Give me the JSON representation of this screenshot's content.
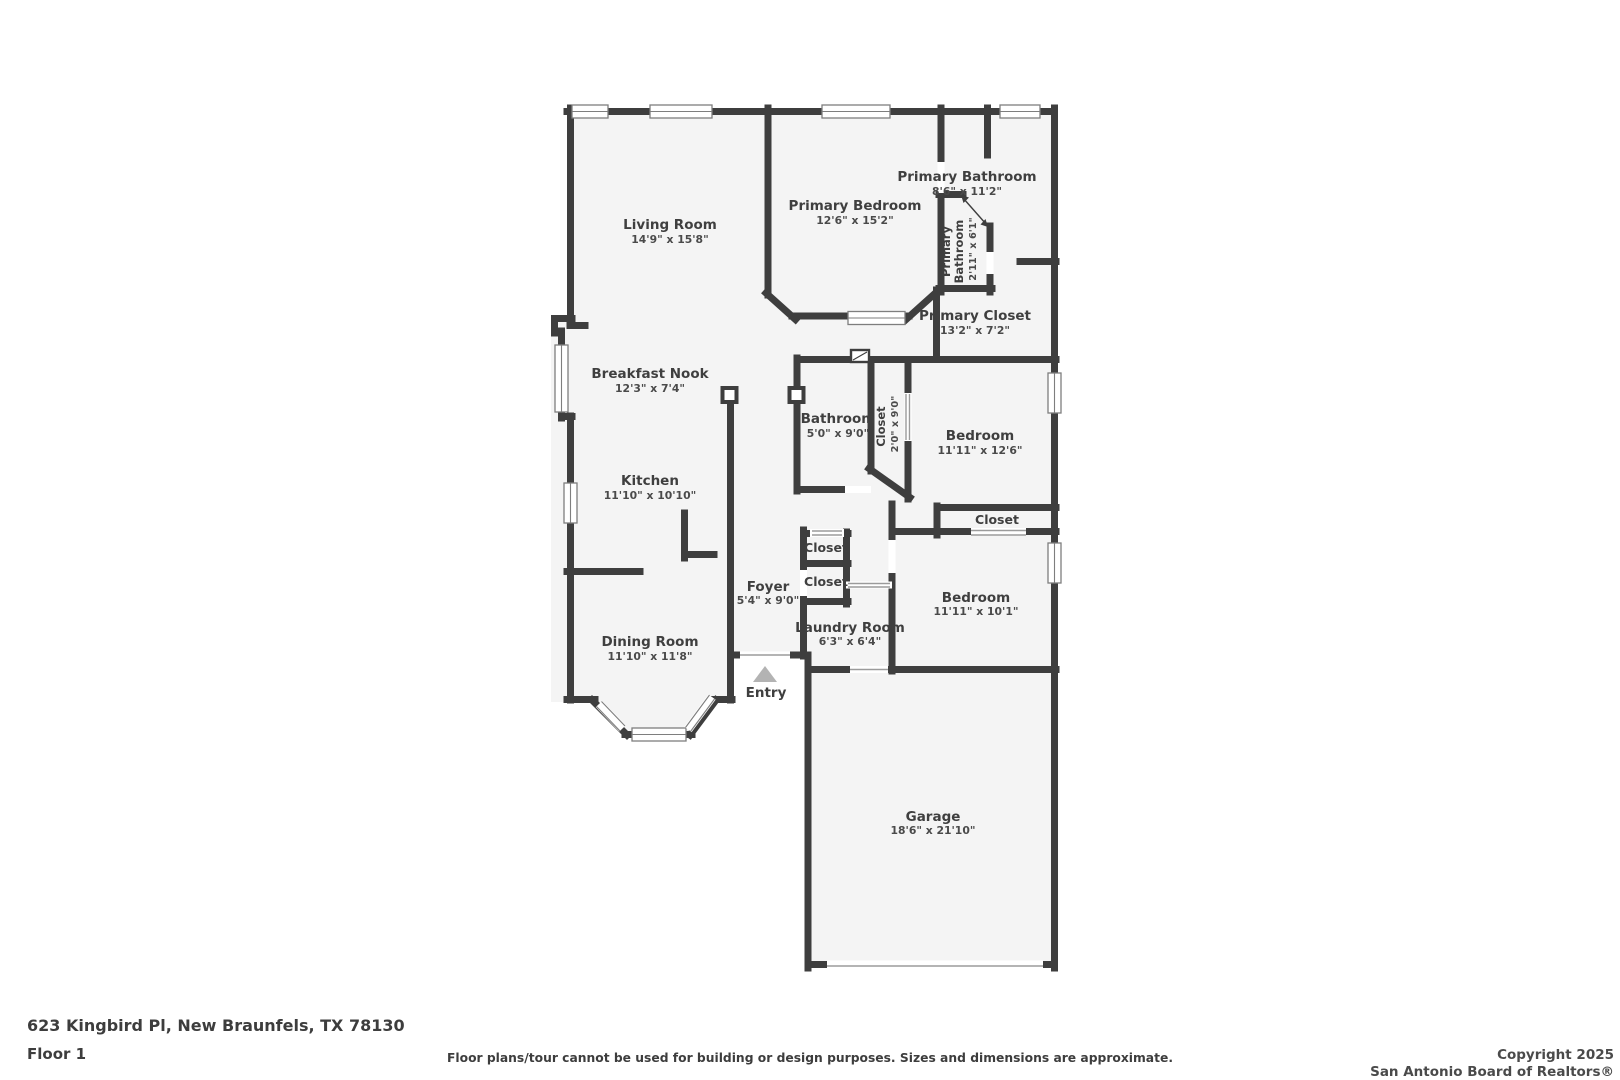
{
  "floorplan": {
    "wall_color": "#3e3e3e",
    "floor_color": "#f4f4f4",
    "window_frame_color": "#7e7e7e",
    "entry_arrow_color": "#b3b3b3",
    "rooms": [
      {
        "id": "living-room",
        "name": "Living Room",
        "dims": "14'9\" x 15'8\""
      },
      {
        "id": "primary-bedroom",
        "name": "Primary Bedroom",
        "dims": "12'6\" x 15'2\""
      },
      {
        "id": "primary-bathroom",
        "name": "Primary Bathroom",
        "dims": "8'6\" x 11'2\""
      },
      {
        "id": "primary-half-bathroom",
        "name": "Primary Bathroom",
        "name_line1": "Primary",
        "name_line2": "Bathroom",
        "dims": "2'11\" x 6'1\""
      },
      {
        "id": "primary-closet",
        "name": "Primary Closet",
        "dims": "13'2\" x 7'2\""
      },
      {
        "id": "breakfast-nook",
        "name": "Breakfast Nook",
        "dims": "12'3\" x 7'4\""
      },
      {
        "id": "bathroom",
        "name": "Bathroom",
        "dims": "5'0\" x 9'0\""
      },
      {
        "id": "hall-closet",
        "name": "Closet",
        "dims": "2'0\" x 9'0\""
      },
      {
        "id": "bedroom-1",
        "name": "Bedroom",
        "dims": "11'11\" x 12'6\""
      },
      {
        "id": "kitchen",
        "name": "Kitchen",
        "dims": "11'10\" x 10'10\""
      },
      {
        "id": "bedroom-1-closet",
        "name": "Closet",
        "dims": ""
      },
      {
        "id": "foyer-closet-upper",
        "name": "Closet",
        "dims": ""
      },
      {
        "id": "foyer-closet-lower",
        "name": "Closet",
        "dims": ""
      },
      {
        "id": "foyer",
        "name": "Foyer",
        "dims": "5'4\" x 9'0\""
      },
      {
        "id": "bedroom-2",
        "name": "Bedroom",
        "dims": "11'11\" x 10'1\""
      },
      {
        "id": "laundry-room",
        "name": "Laundry Room",
        "dims": "6'3\" x 6'4\""
      },
      {
        "id": "dining-room",
        "name": "Dining Room",
        "dims": "11'10\" x 11'8\""
      },
      {
        "id": "entry",
        "name": "Entry",
        "dims": ""
      },
      {
        "id": "garage",
        "name": "Garage",
        "dims": "18'6\" x 21'10\""
      }
    ]
  },
  "footer": {
    "address": "623 Kingbird Pl, New Braunfels, TX 78130",
    "floor_label": "Floor 1",
    "disclaimer": "Floor plans/tour cannot be used for building or design purposes. Sizes and dimensions are approximate.",
    "copyright_line1": "Copyright 2025",
    "copyright_line2": "San Antonio Board of Realtors®"
  }
}
